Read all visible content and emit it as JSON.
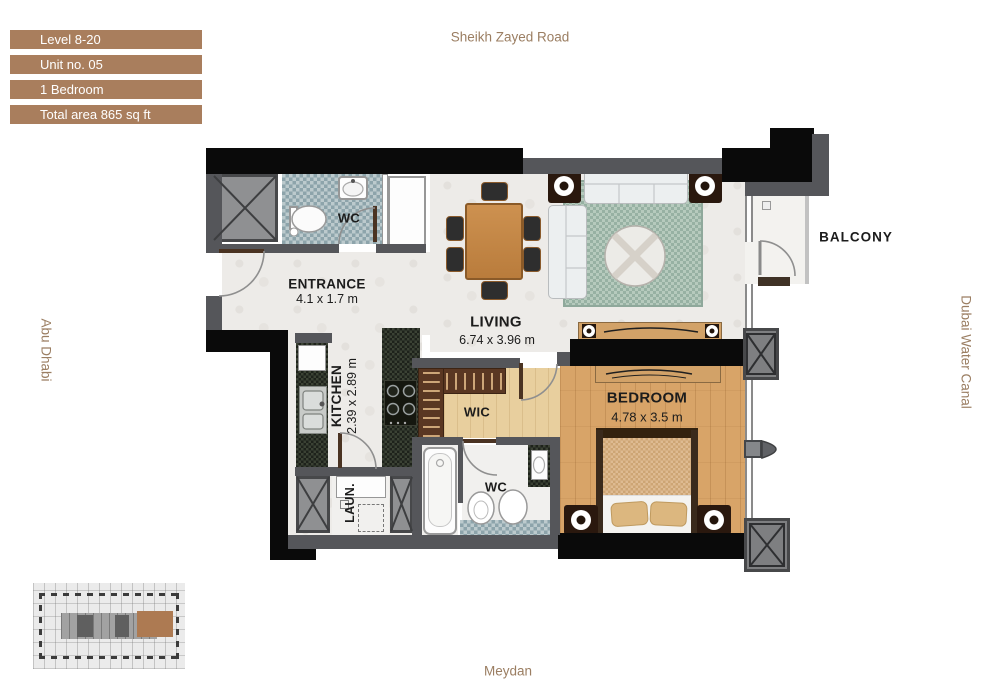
{
  "colors": {
    "brown": "#a97e5d",
    "compass_text": "#9b7e62",
    "wall_black": "#0a0a0a",
    "wall_gray": "#55565a",
    "wood": "#d8a468",
    "wood_light": "#e8cf9e",
    "rug_green": "#a7bfb2",
    "closet_brown": "#5a3722",
    "granite": "#272b23",
    "mosaic": "#9eb2b8",
    "key_unit": "#ad7a52"
  },
  "legend": {
    "items": [
      "Level 8-20",
      "Unit no. 05",
      "1 Bedroom",
      "Total area 865 sq ft"
    ]
  },
  "surroundings": {
    "top": "Sheikh Zayed Road",
    "bottom": "Meydan",
    "left": "Abu Dhabi",
    "right": "Dubai Water Canal"
  },
  "rooms": {
    "entrance": {
      "name": "ENTRANCE",
      "dims": "4.1 x 1.7 m"
    },
    "living": {
      "name": "LIVING",
      "dims": "6.74 x 3.96 m"
    },
    "kitchen": {
      "name": "KITCHEN",
      "dims": "2.39 x 2.89 m"
    },
    "bedroom": {
      "name": "BEDROOM",
      "dims": "4.78 x 3.5 m"
    },
    "guest_wc": {
      "name": "WC"
    },
    "master_wc": {
      "name": "WC"
    },
    "wic": {
      "name": "WIC"
    },
    "laundry": {
      "name": "LAUN."
    },
    "balcony": {
      "name": "BALCONY"
    }
  }
}
